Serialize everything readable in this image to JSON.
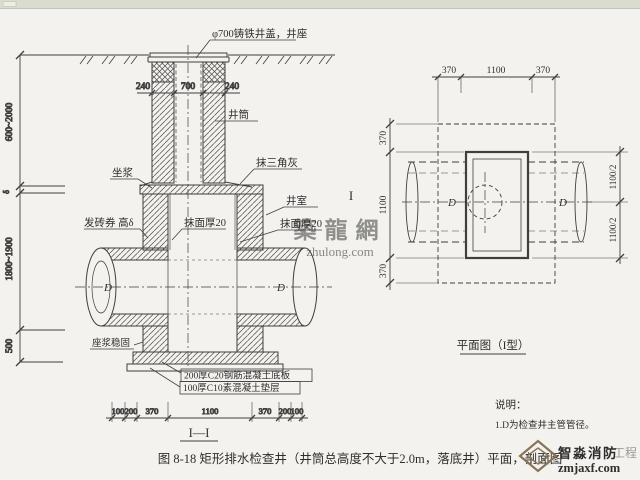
{
  "figure": {
    "caption": "图 8-18  矩形排水检查井（井筒总高度不大于2.0m，落底井）平面，剖面图"
  },
  "section": {
    "labels": {
      "cover": "φ700铸铁井盖，井座",
      "shaft": "井筒",
      "seat_mortar": "坐浆",
      "triangle_plaster": "抹三角灰",
      "chamber": "井室",
      "brick_arch": "发砖券 高δ",
      "plaster_left": "抹面厚20",
      "plaster_right": "抹面厚20",
      "grout_fix": "座浆稳固",
      "base_slab": "200厚C20钢筋混凝土底板",
      "cushion": "100厚C10素混凝土垫层",
      "mark": "I—I",
      "pipe_d_left": "D",
      "pipe_d_right": "D"
    },
    "dims": {
      "height_shaft": "600~2000",
      "arch_delta": "δ",
      "height_chamber": "1800~1900",
      "height_base": "500",
      "wall_left": "240",
      "opening": "700",
      "wall_right": "240",
      "bottom": [
        "100",
        "200",
        "370",
        "1100",
        "370",
        "200",
        "100"
      ]
    }
  },
  "plan": {
    "title": "平面图（I型）",
    "section_letter": "I",
    "dims": {
      "top": [
        "370",
        "1100",
        "370"
      ],
      "left": [
        "370",
        "1100",
        "370"
      ],
      "right_upper": "1100/2",
      "right_lower": "1100/2"
    },
    "pipe_d_left": "D",
    "pipe_d_right": "D"
  },
  "notes": {
    "heading": "说明：",
    "items": [
      "1.D为检查井主管管径。"
    ]
  },
  "watermarks": {
    "center_text": "築龍網",
    "center_url": "zhulong.com",
    "brand_text": "智淼消防",
    "brand_ghost": "工程",
    "brand_url": "zmjaxf.com"
  },
  "colors": {
    "line": "#3f3f3f",
    "paper": "#f3f2ee",
    "topbar": "#d9dccf",
    "watermark_pink": "#c88b86",
    "brand_brown": "#8a7458"
  }
}
